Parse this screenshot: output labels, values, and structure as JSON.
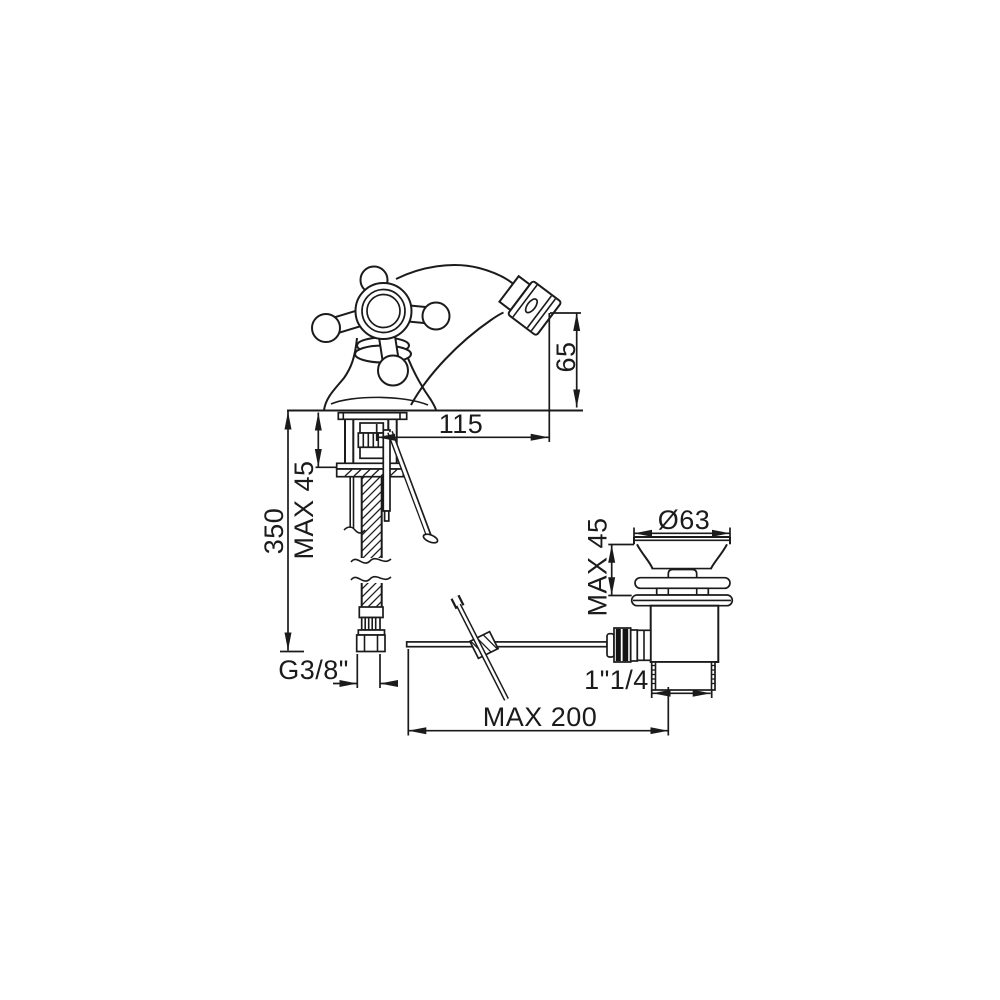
{
  "page": {
    "background": "#ffffff",
    "line_color": "#1b1b1b"
  },
  "drawing": {
    "dimensions": {
      "spout_height": "65",
      "spout_reach": "115",
      "supply_length": "350",
      "deck_thickness_faucet": "MAX 45",
      "supply_thread": "G3/8\"",
      "waste_flange_diameter": "Ø63",
      "deck_thickness_waste": "MAX 45",
      "waste_thread": "1\"1/4",
      "rod_length": "MAX 200"
    }
  }
}
